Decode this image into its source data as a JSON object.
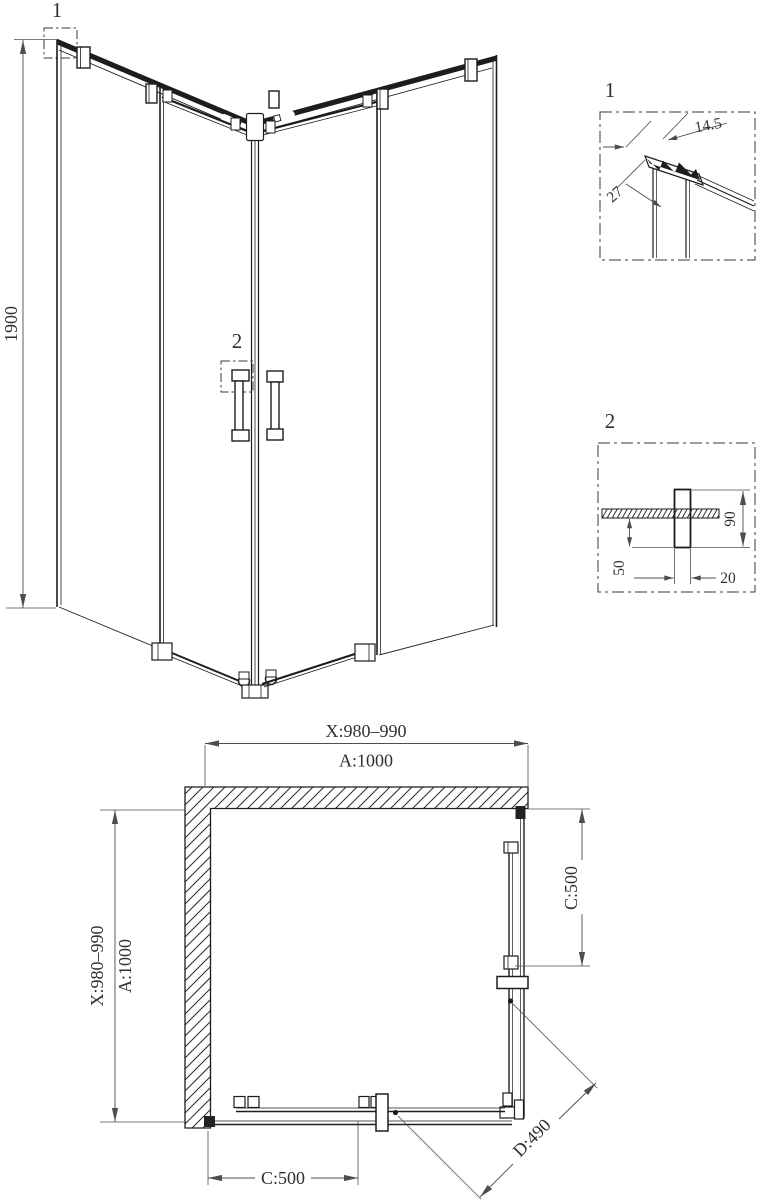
{
  "perspective": {
    "callout_top": "1",
    "callout_handle": "2",
    "height_dim": "1900"
  },
  "detail_1": {
    "label": "1",
    "dim_profile_width": "14.5",
    "dim_profile_depth": "27"
  },
  "detail_2": {
    "label": "2",
    "dim_below_glass": "50",
    "dim_handle_height": "90",
    "dim_handle_width": "20"
  },
  "plan_view": {
    "width_adjust": "X:980–990",
    "width_nominal": "A:1000",
    "depth_adjust": "X:980–990",
    "depth_nominal": "A:1000",
    "door_right": "C:500",
    "door_bottom": "C:500",
    "diagonal_entry": "D:490"
  },
  "colors": {
    "line": "#1d1d1d",
    "dim_line": "#4d4d4d",
    "text": "#303030",
    "background": "#ffffff"
  }
}
